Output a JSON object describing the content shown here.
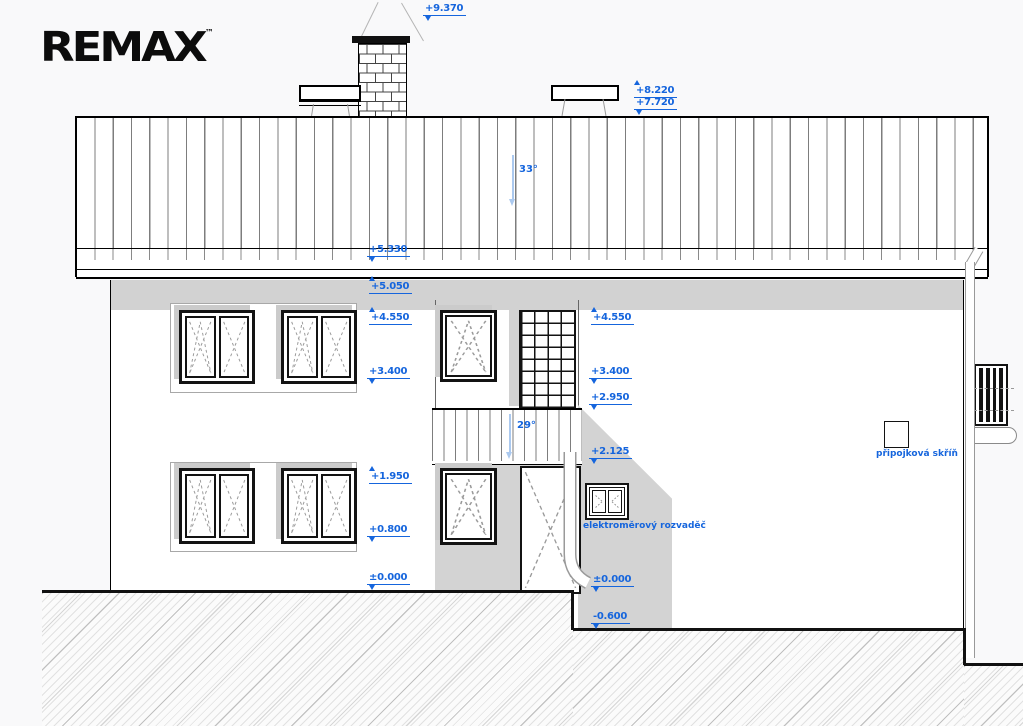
{
  "title_block": {
    "logo_text": "REMAX",
    "logo_trademark": "™"
  },
  "drawing": {
    "type": "house-elevation",
    "view": "side elevation with terrain section"
  },
  "slope_labels": {
    "main_roof": "33°",
    "porch_roof": "29°"
  },
  "equipment_labels": {
    "meter_board": "elektroměrový rozvaděč",
    "connection_box": "připojková skříň"
  },
  "elevation_marks": [
    {
      "value": "+9.370",
      "dir": "down"
    },
    {
      "value": "+8.220",
      "dir": "up"
    },
    {
      "value": "+7.720",
      "dir": "down"
    },
    {
      "value": "+5.330",
      "dir": "down"
    },
    {
      "value": "+5.050",
      "dir": "up"
    },
    {
      "value": "+4.550",
      "dir": "up"
    },
    {
      "value": "+3.400",
      "dir": "down"
    },
    {
      "value": "+1.950",
      "dir": "up"
    },
    {
      "value": "+0.800",
      "dir": "down"
    },
    {
      "value": "±0.000",
      "dir": "down"
    },
    {
      "value": "+4.550",
      "dir": "up"
    },
    {
      "value": "+3.400",
      "dir": "down"
    },
    {
      "value": "+2.950",
      "dir": "down"
    },
    {
      "value": "+2.125",
      "dir": "down"
    },
    {
      "value": "±0.000",
      "dir": "down"
    },
    {
      "value": "-0.600",
      "dir": "down"
    }
  ],
  "colors": {
    "annotation_blue": "#1565dd",
    "arrow_light_blue": "#abc9ef",
    "shade_gray": "#d2d2d2",
    "line_black": "#111111"
  }
}
